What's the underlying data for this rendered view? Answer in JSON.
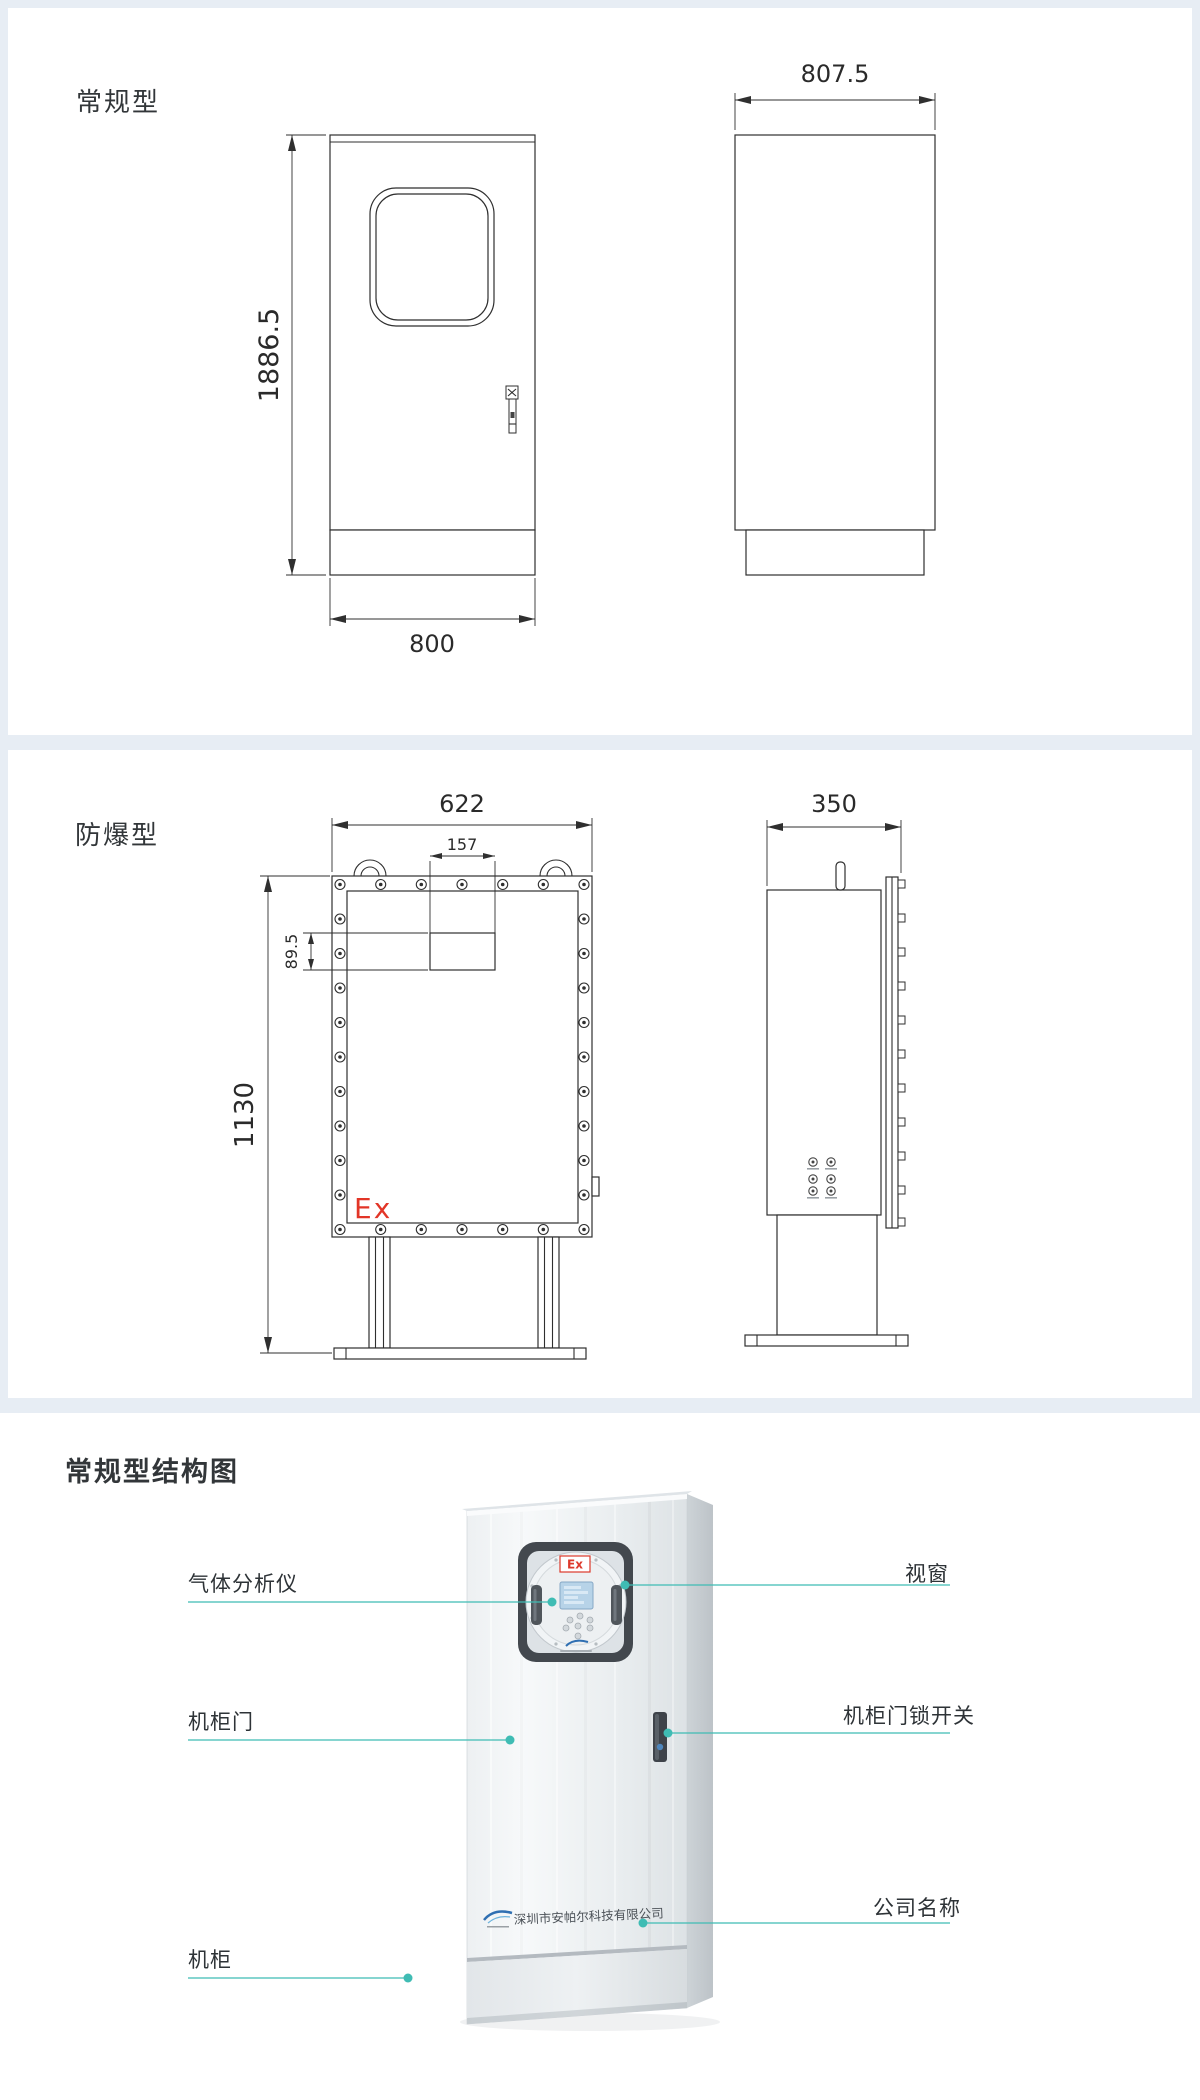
{
  "page": {
    "background": "#ffffff",
    "frame_color": "#e7edf4"
  },
  "regular_section": {
    "title": "常规型",
    "front_view": {
      "dim_height": "1886.5",
      "dim_width": "800"
    },
    "side_view": {
      "dim_depth": "807.5"
    }
  },
  "explosion_section": {
    "title": "防爆型",
    "front_view": {
      "dim_width": "622",
      "dim_cutout_width": "157",
      "dim_cutout_height": "89.5",
      "dim_height": "1130",
      "ex_mark": "Ex"
    },
    "side_view": {
      "dim_depth": "350"
    }
  },
  "structure_section": {
    "title": "常规型结构图",
    "window_ex_mark": "Ex",
    "company_name": "深圳市安帕尔科技有限公司",
    "callouts": {
      "left": [
        {
          "label": "气体分析仪"
        },
        {
          "label": "机柜门"
        },
        {
          "label": "机柜"
        }
      ],
      "right": [
        {
          "label": "视窗"
        },
        {
          "label": "机柜门锁开关"
        },
        {
          "label": "公司名称"
        }
      ]
    },
    "colors": {
      "callout_line": "#3fbcb4",
      "ex_red": "#e23527",
      "lock_dot_blue": "#4e86bd",
      "logo_blue": "#2f6fb2"
    }
  }
}
